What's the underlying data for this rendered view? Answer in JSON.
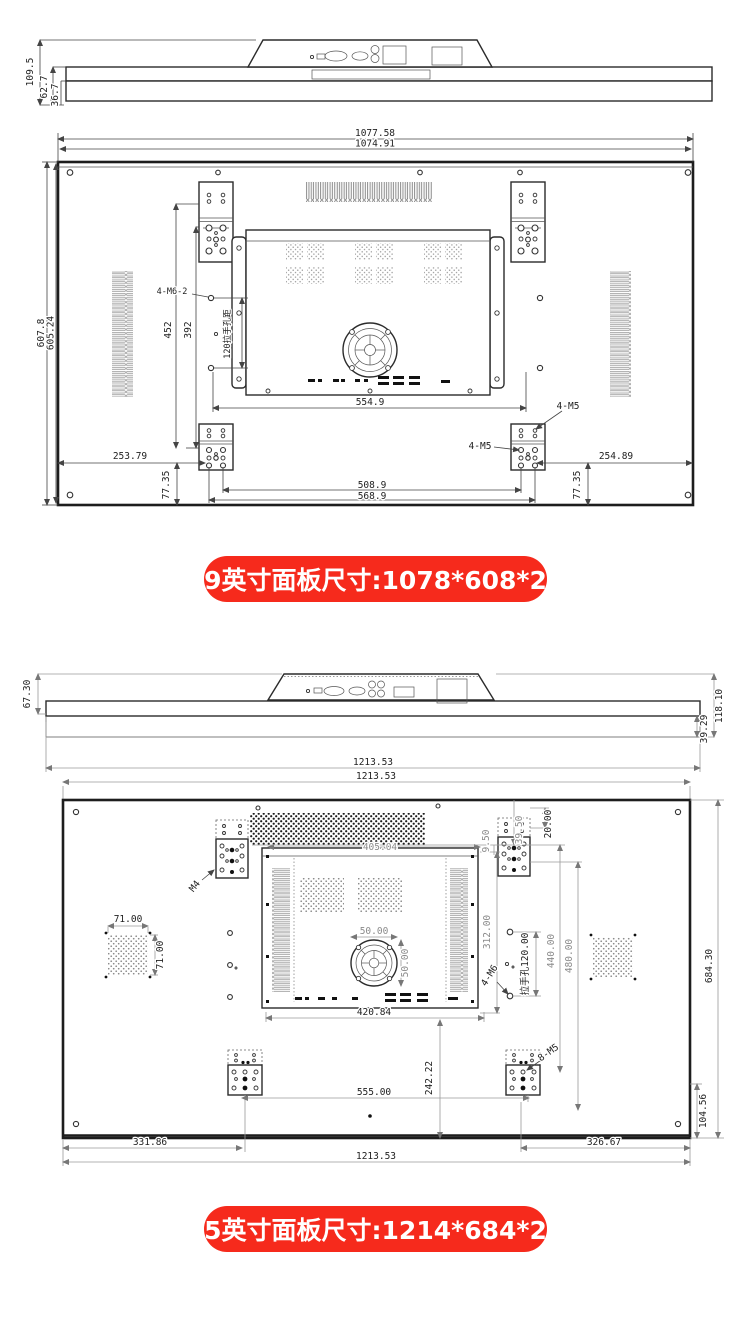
{
  "accent_color": "#f62a1c",
  "banner_49": {
    "label": "49英寸面板尺寸:1078*608*26"
  },
  "banner_55": {
    "label": "55英寸面板尺寸:1214*684*28"
  },
  "d49": {
    "side": {
      "height_total": "109.5",
      "height_mid": "62.7",
      "height_body": "36.7"
    },
    "rear": {
      "width_outer": "1077.58",
      "width_inner": "1074.91",
      "height_outer": "607.8",
      "height_inner": "605.24",
      "vesa_v1": "452",
      "vesa_v2": "392",
      "screw_spec_top": "4-M6-2",
      "handle_pitch": "120拉手孔距",
      "box_width": "554.9",
      "screw_spec_r1": "4-M5",
      "screw_spec_r2": "4-M5",
      "left_offset": "253.79",
      "left_bottom": "77.35",
      "hole_span_inner": "508.9",
      "hole_span_outer": "568.9",
      "right_offset": "254.89",
      "right_bottom": "77.35"
    }
  },
  "d55": {
    "side": {
      "height_front": "67.30",
      "height_total": "118.10",
      "height_back": "39.29",
      "width": "1213.53"
    },
    "rear": {
      "width_top": "1213.53",
      "vent_width": "405.04",
      "screw_m4": "M4",
      "top_offset": "20.00",
      "edge_gap": "9.50",
      "hole_offset": "39.50",
      "mesh_w": "71.00",
      "mesh_h": "71.00",
      "fan_w": "50.00",
      "fan_h": "50.00",
      "box_width": "420.84",
      "box_height": "312.00",
      "handle_pitch": "拉手孔120.00",
      "screw_m6": "4-M6",
      "vesa_v1": "440.00",
      "vesa_v2": "480.00",
      "height_right": "684.30",
      "bottom_rise": "242.22",
      "screw_m5": "8-M5",
      "bracket_span": "555.00",
      "corner_rise": "104.56",
      "left_offset": "331.86",
      "right_offset": "326.67",
      "width_bottom": "1213.53"
    }
  }
}
